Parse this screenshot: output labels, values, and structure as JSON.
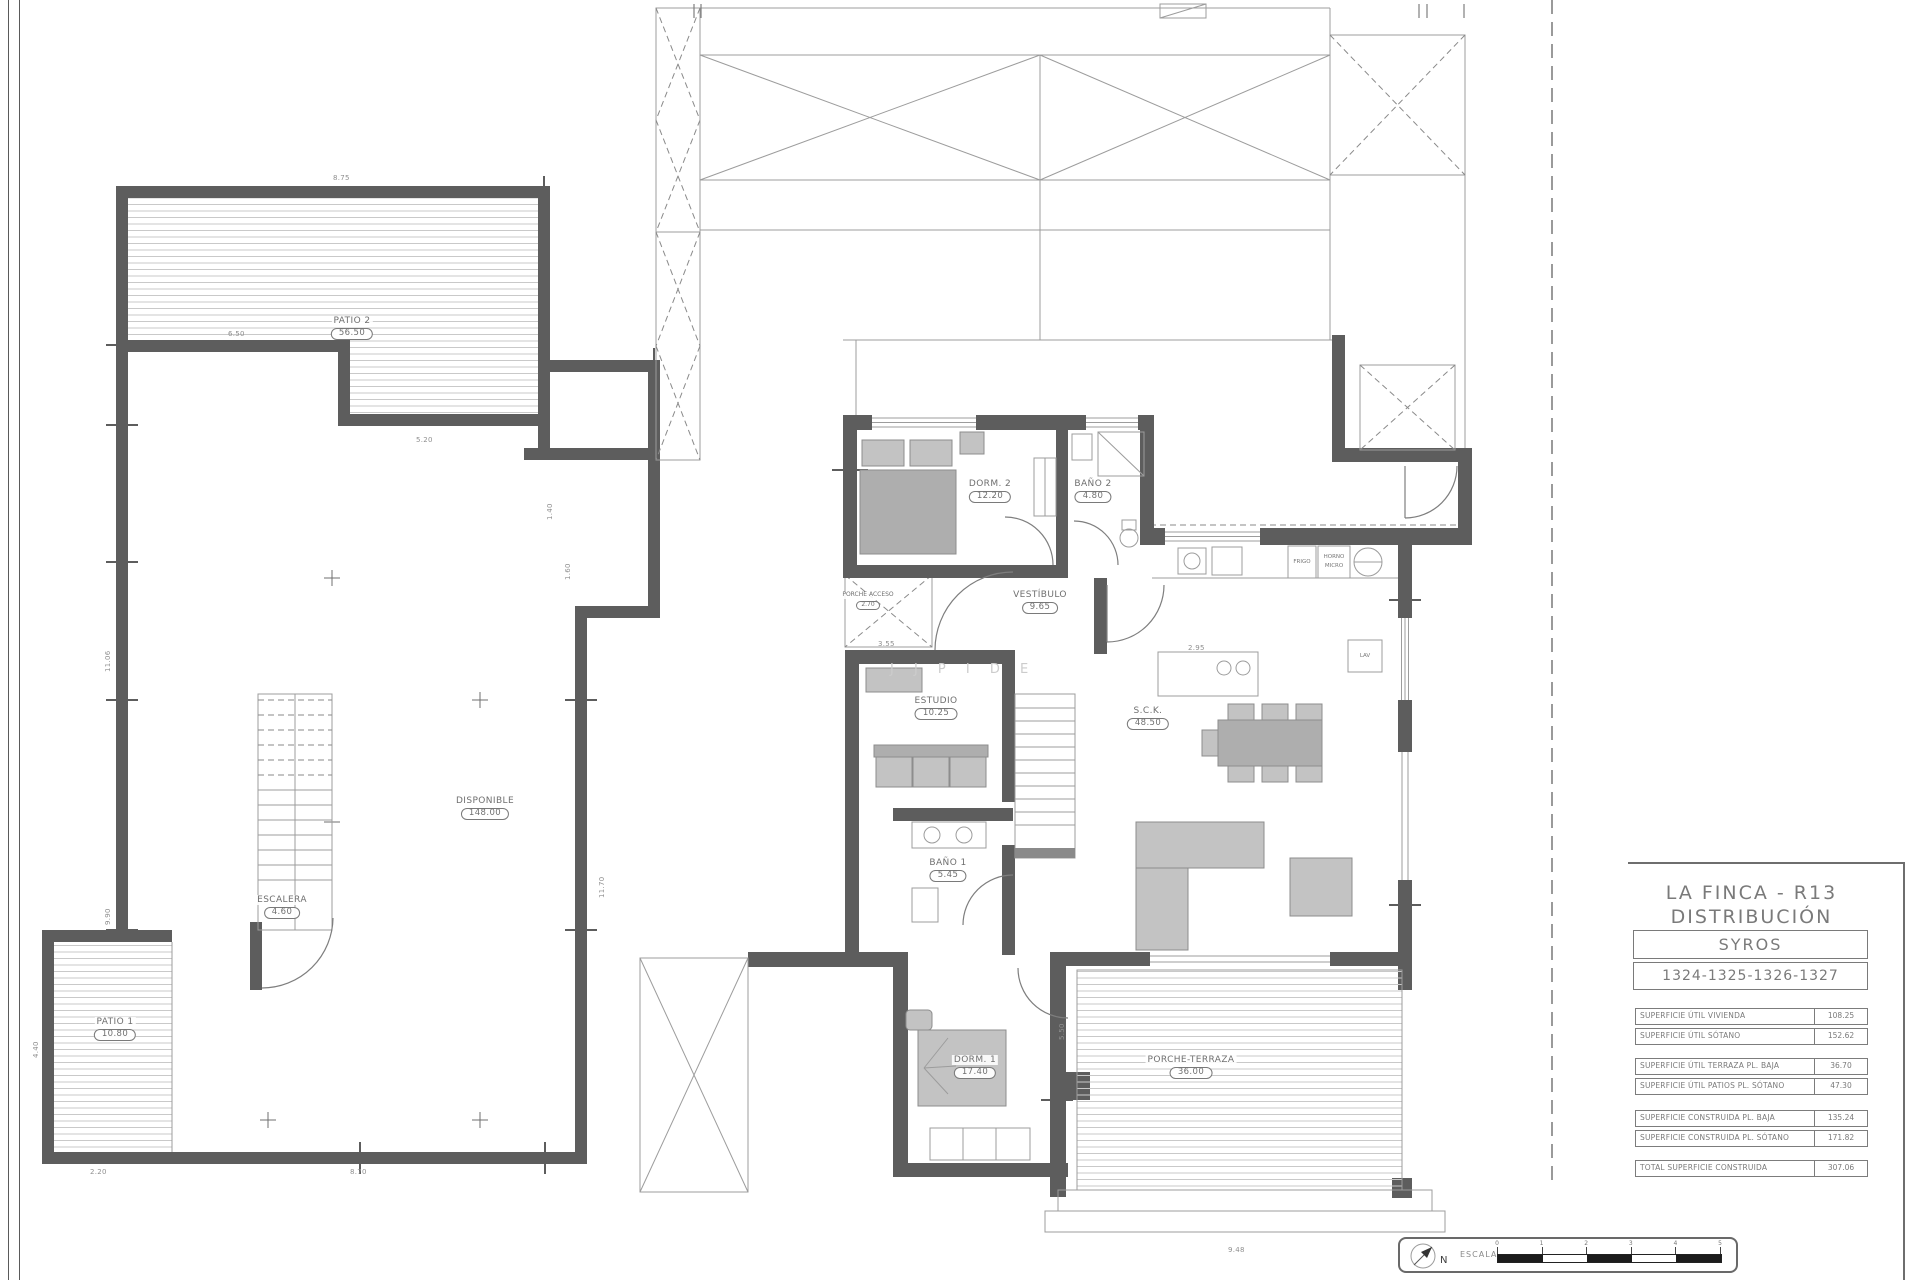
{
  "title_block": {
    "project": "LA FINCA - R13",
    "subtitle": "DISTRIBUCIÓN",
    "model": "SYROS",
    "units": "1324-1325-1326-1327"
  },
  "area_tables": {
    "groups": [
      {
        "rows": [
          {
            "label": "SUPERFICIE ÚTIL VIVIENDA",
            "value": "108.25"
          },
          {
            "label": "SUPERFICIE ÚTIL SÓTANO",
            "value": "152.62"
          }
        ]
      },
      {
        "rows": [
          {
            "label": "SUPERFICIE ÚTIL TERRAZA PL. BAJA",
            "value": "36.70"
          },
          {
            "label": "SUPERFICIE ÚTIL PATIOS PL. SÓTANO",
            "value": "47.30"
          }
        ]
      },
      {
        "rows": [
          {
            "label": "SUPERFICIE CONSTRUIDA PL. BAJA",
            "value": "135.24"
          },
          {
            "label": "SUPERFICIE CONSTRUIDA PL. SÓTANO",
            "value": "171.82"
          }
        ]
      },
      {
        "rows": [
          {
            "label": "TOTAL SUPERFICIE CONSTRUIDA",
            "value": "307.06"
          }
        ]
      }
    ]
  },
  "basement": {
    "rooms": [
      {
        "name": "PATIO 2",
        "area": "56.50"
      },
      {
        "name": "DISPONIBLE",
        "area": "148.00"
      },
      {
        "name": "ESCALERA",
        "area": "4.60"
      },
      {
        "name": "PATIO 1",
        "area": "10.80"
      }
    ]
  },
  "ground": {
    "rooms": [
      {
        "name": "DORM. 2",
        "area": "12.20"
      },
      {
        "name": "BAÑO 2",
        "area": "4.80"
      },
      {
        "name": "VESTÍBULO",
        "area": "9.65"
      },
      {
        "name": "PORCHE ACCESO",
        "area": "2.70"
      },
      {
        "name": "ESTUDIO",
        "area": "10.25"
      },
      {
        "name": "BAÑO 1",
        "area": "5.45"
      },
      {
        "name": "S.C.K.",
        "area": "48.50"
      },
      {
        "name": "DORM. 1",
        "area": "17.40"
      },
      {
        "name": "PORCHE-TERRAZA",
        "area": "36.00"
      }
    ]
  },
  "kitchen_labels": {
    "fridge": "FRIGO",
    "oven_line1": "HORNO",
    "oven_line2": "MICRO",
    "laundry": "LAV"
  },
  "watermark": "J J  P I D E",
  "scale_bar": {
    "label": "ESCALA",
    "north": "N",
    "ticks": [
      "0",
      "1",
      "2",
      "3",
      "4",
      "5"
    ]
  },
  "dims": [
    {
      "text": "8.75"
    },
    {
      "text": "6.50"
    },
    {
      "text": "11.06"
    },
    {
      "text": "9.90"
    },
    {
      "text": "11.70"
    },
    {
      "text": "8.70"
    },
    {
      "text": "2.20"
    },
    {
      "text": "4.40"
    },
    {
      "text": "5.20"
    },
    {
      "text": "1.40"
    },
    {
      "text": "1.60"
    },
    {
      "text": "2.95"
    },
    {
      "text": "5.50"
    },
    {
      "text": "9.48"
    },
    {
      "text": "3.55"
    }
  ]
}
